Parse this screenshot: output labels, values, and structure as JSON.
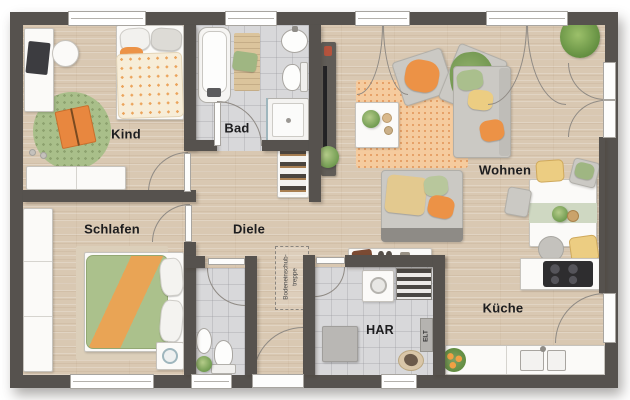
{
  "rooms": {
    "kind": {
      "label": "Kind"
    },
    "bad": {
      "label": "Bad"
    },
    "wohnen": {
      "label": "Wohnen"
    },
    "schlafen": {
      "label": "Schlafen"
    },
    "diele": {
      "label": "Diele"
    },
    "har": {
      "label": "HAR"
    },
    "kueche": {
      "label": "Küche"
    }
  },
  "annotations": {
    "attic_stairs_line1": "Bodeneinschub-",
    "attic_stairs_line2": "treppe",
    "electrical": "ELT"
  },
  "colors": {
    "wall": "#56524e",
    "wood-floor": "#d9c8b2",
    "tile-floor": "#d8d8da",
    "rug-orange": "#f5cb9e",
    "rug-green": "#a9bf8a",
    "sofa-gray": "#cbc9c4",
    "accent-orange": "#ec9246",
    "accent-green": "#9fb682",
    "accent-yellow": "#eccd82",
    "label-text": "#1d1d1f"
  }
}
